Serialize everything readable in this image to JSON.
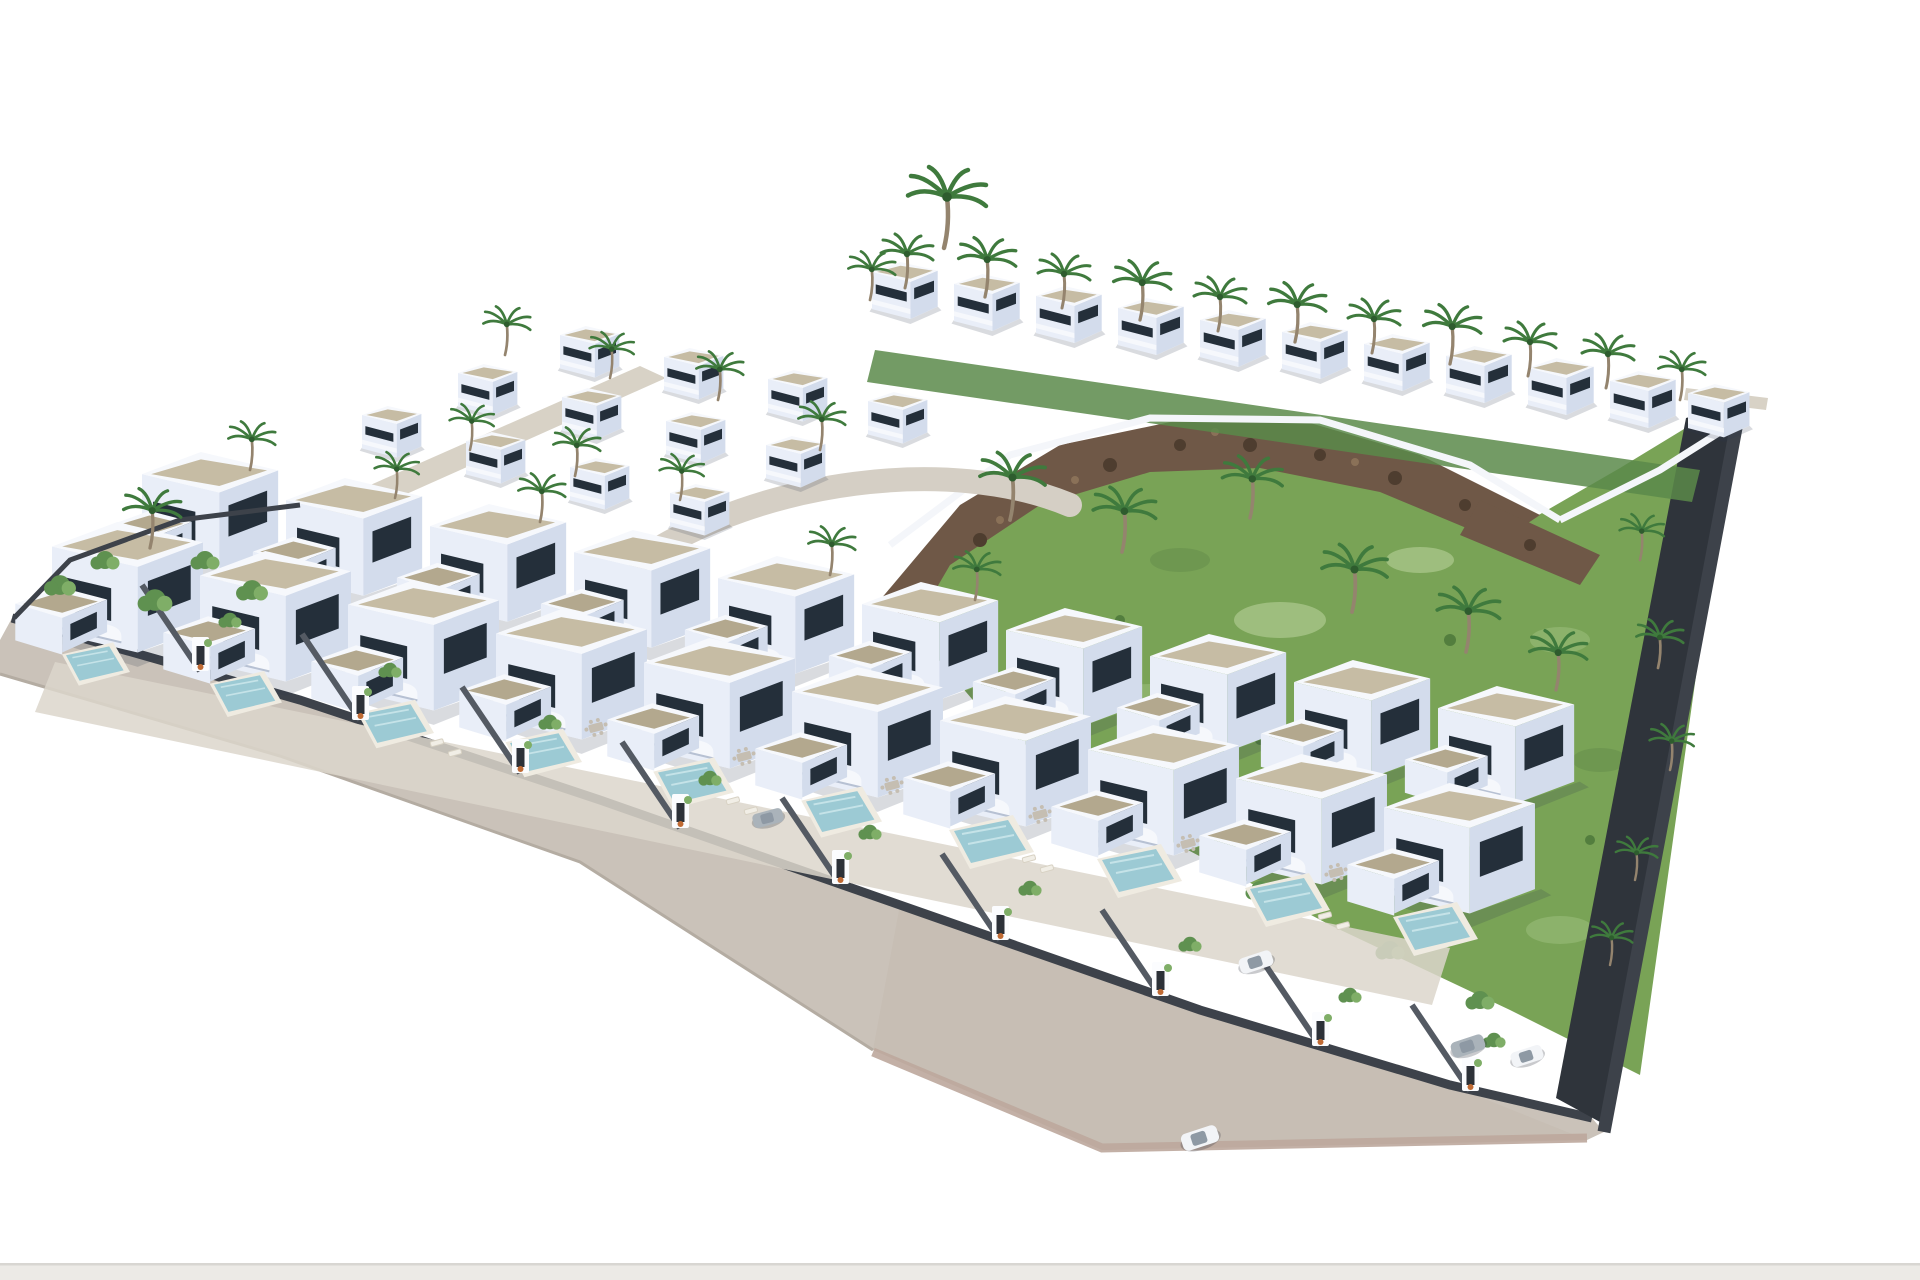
{
  "meta": {
    "type": "3d-aerial-architectural-render",
    "description": "Aerial 3D render of a modern residential development on a rhomboid hillside plot isolated on a white background: dense rows of white cubic villas with gravel flat roofs, curved balconies and dark glazing; private gardens with turquoise plunge pools, sun loungers and dining sets behind dark grey walls with white entry portals along a curving beige perimeter road; a large green meadow with a brown rocky ridge occupies the centre-right; an upper row of two-storey villas lined with palm trees runs along the top edge; scattered palms, shrubs and a few parked cars complete the scene.",
    "visible_text": "none"
  },
  "colors": {
    "background": "#ffffff",
    "villa-white": "#f6f8fc",
    "villa-light": "#e9eef8",
    "villa-mid": "#d3dcec",
    "window": "#242f3a",
    "roof-gravel": "#c6bca4",
    "roof-gravel-dark": "#b3a88e",
    "road": "#cac2b9",
    "road-apron": "#c4bbb1",
    "sidewalk-edge": "#bda79c",
    "patio": "#dcd6cb",
    "path-beige": "#d8d2c6",
    "wall-dark": "#3d424a",
    "wall-mid": "#545a63",
    "gravel-strip": "#2f343b",
    "meadow": "#79a356",
    "meadow-light": "#a3c283",
    "meadow-dark": "#4f7a3c",
    "rock": "#6f5847",
    "rock-dark": "#4e3d2f",
    "palm-green": "#3f7a3d",
    "palm-trunk": "#94846e",
    "tree-green": "#5f9150",
    "pool": "#9ccad4",
    "car-white": "#f2f4f7",
    "car-gray": "#aab3ba",
    "planter-orange": "#c06a33",
    "bottom-band": "#eceae6",
    "bottom-band-line": "#d8d6d2",
    "hedge": "#5b8a4a"
  },
  "scene": {
    "site_shape": "rhomboid plot viewed from an elevated south-west angle on pure white backdrop",
    "regions": [
      "perimeter-road",
      "foreground-villa-rows",
      "mid-hill-villa-cluster",
      "upper-villa-row",
      "green-meadow",
      "rocky-ridge",
      "right-boundary-wall",
      "left-corner-garden"
    ],
    "counts": {
      "foreground_villas": 20,
      "hillside_villas": 12,
      "upper_row_villas": 11,
      "palm_trees": 40,
      "shrubs": 25,
      "pools": 10,
      "entry_gates": 9,
      "cars": 5
    }
  }
}
